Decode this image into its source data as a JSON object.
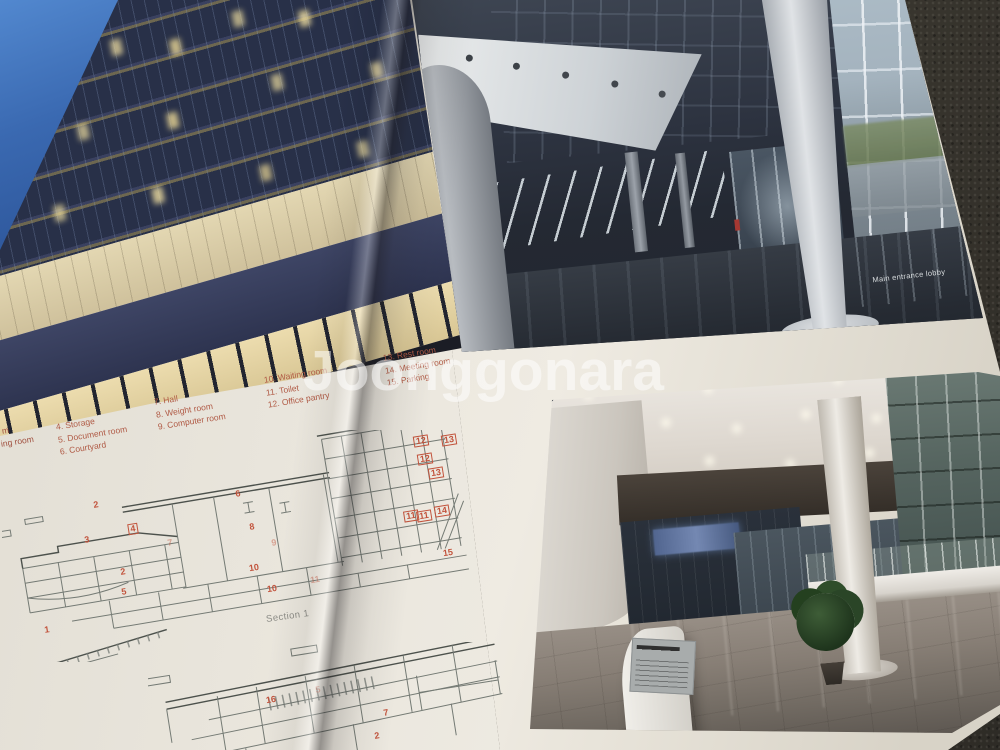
{
  "watermark": "Joonggonara",
  "left_page": {
    "legend": {
      "fragments": [
        "m",
        "ing room"
      ],
      "columns": [
        [
          "4. Storage",
          "5. Document room",
          "6. Courtyard"
        ],
        [
          "7. Hall",
          "8. Weight room",
          "9. Computer room"
        ],
        [
          "10. Waiting room",
          "11. Toilet",
          "12. Office pantry"
        ],
        [
          "13. Rest room",
          "14. Meeting room",
          "15. Parking"
        ]
      ],
      "text_color": "#b05a45"
    },
    "section1": {
      "label": "Section 1",
      "numbers": [
        {
          "t": "1",
          "x": 47,
          "y": 630
        },
        {
          "t": "2",
          "x": 96,
          "y": 505
        },
        {
          "t": "2",
          "x": 123,
          "y": 572
        },
        {
          "t": "3",
          "x": 87,
          "y": 540
        },
        {
          "t": "4",
          "x": 133,
          "y": 529,
          "boxed": true
        },
        {
          "t": "5",
          "x": 124,
          "y": 592
        },
        {
          "t": "6",
          "x": 238,
          "y": 494
        },
        {
          "t": "7",
          "x": 170,
          "y": 543,
          "faded": true
        },
        {
          "t": "8",
          "x": 252,
          "y": 527
        },
        {
          "t": "9",
          "x": 274,
          "y": 543,
          "faded": true
        },
        {
          "t": "10",
          "x": 254,
          "y": 568
        },
        {
          "t": "10",
          "x": 272,
          "y": 589
        },
        {
          "t": "11",
          "x": 315,
          "y": 580,
          "faded": true
        },
        {
          "t": "11",
          "x": 411,
          "y": 516,
          "boxed": true
        },
        {
          "t": "11",
          "x": 424,
          "y": 516,
          "boxed": true
        },
        {
          "t": "12",
          "x": 421,
          "y": 441,
          "boxed": true
        },
        {
          "t": "12",
          "x": 425,
          "y": 459,
          "boxed": true
        },
        {
          "t": "13",
          "x": 449,
          "y": 440,
          "boxed": true
        },
        {
          "t": "13",
          "x": 436,
          "y": 473,
          "boxed": true
        },
        {
          "t": "14",
          "x": 442,
          "y": 511,
          "boxed": true
        },
        {
          "t": "15",
          "x": 448,
          "y": 553
        }
      ]
    },
    "section2": {
      "numbers": [
        {
          "t": "16",
          "x": 271,
          "y": 700
        },
        {
          "t": "5",
          "x": 318,
          "y": 690,
          "faded": true
        },
        {
          "t": "7",
          "x": 386,
          "y": 713
        },
        {
          "t": "2",
          "x": 377,
          "y": 736
        }
      ]
    }
  },
  "right_page": {
    "top_photo_caption": "Main entrance lobby"
  },
  "colors": {
    "legend_text": "#b05a45",
    "drawing_red": "#c2533c",
    "paper": "#eae6dd",
    "carpet": "#3f3b34",
    "watermark": "#ffffff"
  }
}
